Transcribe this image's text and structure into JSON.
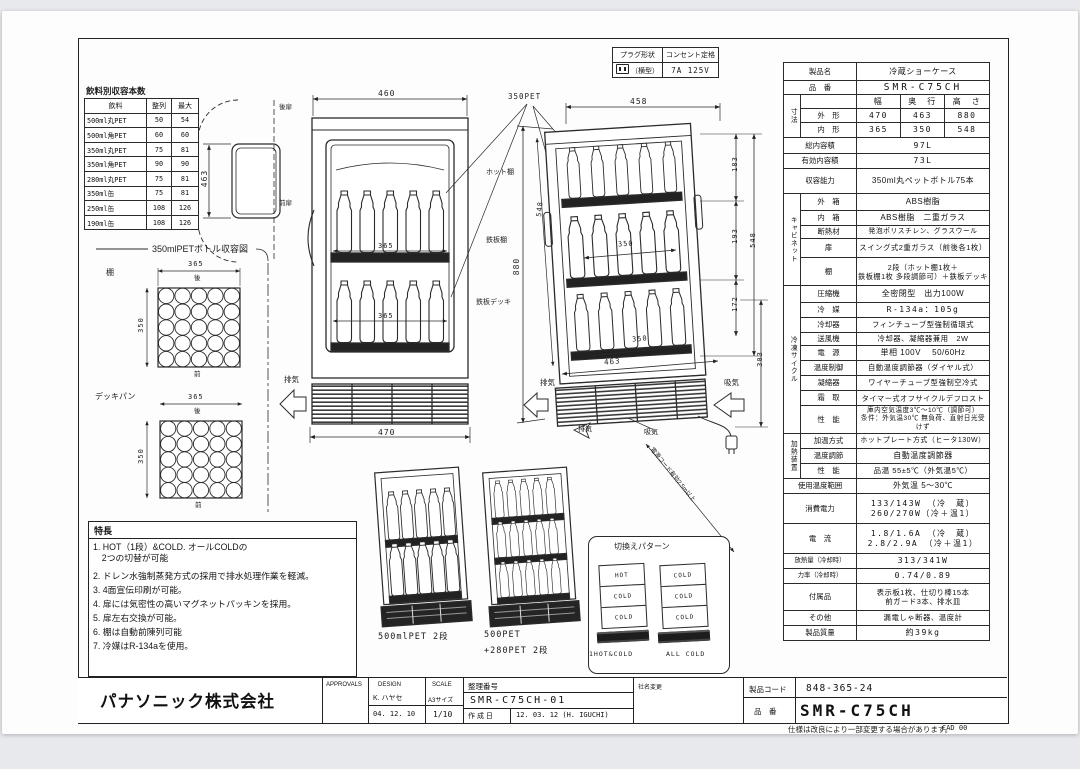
{
  "doc": {
    "sheet_note": "仕様は改良により一部変更する場合があります。",
    "cad_note": "CAD 00"
  },
  "plug_table": {
    "plug_header": "プラグ形状",
    "outlet_header": "コンセント定格",
    "plug_type": "（横型）",
    "outlet_rating": "7A 125V"
  },
  "capacity_table": {
    "title": "飲料別収容本数",
    "headers": [
      "飲料",
      "整列",
      "最大"
    ],
    "rows": [
      [
        "500ml丸PET",
        "50",
        "54"
      ],
      [
        "500ml角PET",
        "60",
        "60"
      ],
      [
        "350ml丸PET",
        "75",
        "81"
      ],
      [
        "350ml角PET",
        "90",
        "90"
      ],
      [
        "280ml丸PET",
        "75",
        "81"
      ],
      [
        "350ml缶",
        "75",
        "81"
      ],
      [
        "250ml缶",
        "108",
        "126"
      ],
      [
        "190ml缶",
        "108",
        "126"
      ]
    ]
  },
  "bottle_layout": {
    "title": "350mlPETボトル収容図",
    "shelf": "棚",
    "deck": "デッキパン",
    "width": "365",
    "depth": "350",
    "rear": "後",
    "front": "前"
  },
  "views": {
    "plan": {
      "depth": "463",
      "rear_door": "後扉",
      "front_door": "前扉"
    },
    "front": {
      "width_top": "460",
      "inner_width_1": "365",
      "inner_width_2": "365",
      "width_bottom": "470",
      "exhaust": "排気"
    },
    "side": {
      "pet": "350PET",
      "width_top": "458",
      "height": "880",
      "inner_height": "548",
      "seg1": "183",
      "seg2": "193",
      "seg3": "172",
      "inner_height_right": "548",
      "shelf_depth": "350",
      "deck_depth": "350",
      "depth_bottom": "463",
      "machine_height": "303",
      "hot_shelf": "ホット棚",
      "steel_shelf": "鉄板棚",
      "steel_deck": "鉄板デッキ",
      "exhaust_left": "排気",
      "intake_right": "吸気",
      "exhaust_bottom": "排気",
      "intake_bottom": "吸気",
      "cord_note": "電源コード有効2.5m以上"
    },
    "bottom_units": {
      "unit1": "500mlPET 2段",
      "unit2_line1": "500PET",
      "unit2_line2": "+280PET 2段"
    }
  },
  "switch_patterns": {
    "title": "切換えパターン",
    "unit1_bands": [
      "HOT",
      "COLD",
      "COLD"
    ],
    "unit1_label": "1HOT&COLD",
    "unit2_bands": [
      "COLD",
      "COLD",
      "COLD"
    ],
    "unit2_label": "ALL COLD"
  },
  "features": {
    "title": "特長",
    "items": [
      "1. HOT（1段）&COLD. オールCOLDの\n　2つの切替が可能",
      "2. ドレン水強制蒸発方式の採用で排水処理作業を軽減。",
      "3. 4面宣伝印刷が可能。",
      "4. 扉には気密性の高いマグネットパッキンを採用。",
      "5. 扉左右交換が可能。",
      "6. 棚は自動前陳列可能",
      "7. 冷媒はR-134aを使用。"
    ]
  },
  "spec_table": {
    "rows": [
      {
        "label": "製品名",
        "value": "冷蔵ショーケース",
        "h": 18,
        "full": true
      },
      {
        "label": "品　番",
        "value": "SMR-C75CH",
        "h": 14,
        "full": true,
        "big": true
      },
      {
        "group": "寸法",
        "gspan": 3,
        "label": "",
        "cols": [
          "幅",
          "奥　行",
          "高　さ"
        ],
        "h": 14
      },
      {
        "label": "外　形",
        "cols": [
          "470",
          "463",
          "880"
        ],
        "h": 14
      },
      {
        "label": "内　形",
        "cols": [
          "365",
          "350",
          "548"
        ],
        "h": 15
      },
      {
        "label": "総内容積",
        "value": "97L",
        "h": 16,
        "full": true,
        "num": true
      },
      {
        "label": "有効内容積",
        "value": "73L",
        "h": 15,
        "full": true,
        "num": true
      },
      {
        "label": "収容能力",
        "value": "350ml丸ペットボトル75本",
        "h": 25,
        "full": true
      },
      {
        "group": "キャビネット",
        "gspan": 5,
        "label": "外　箱",
        "value": "ABS樹脂",
        "h": 17
      },
      {
        "label": "内　箱",
        "value": "ABS樹脂　二重ガラス",
        "h": 15
      },
      {
        "label": "断熱材",
        "value": "発泡ポリスチレン、グラスウール",
        "h": 13,
        "fs": 6.8
      },
      {
        "label": "扉",
        "value": "スイング式2重ガラス（前後各1枚）",
        "h": 19,
        "fs": 7.4
      },
      {
        "label": "棚",
        "value": "2段（ホット棚1枚＋\n鉄板棚1枚 多段調節可）＋鉄板デッキ",
        "h": 28,
        "fs": 7.2
      },
      {
        "group": "冷凍サイクル",
        "gspan": 9,
        "label": "圧縮機",
        "value": "全密閉型　出力100W",
        "h": 17
      },
      {
        "label": "冷　媒",
        "value": "R-134a：105g",
        "h": 15,
        "num": true
      },
      {
        "label": "冷却器",
        "value": "フィンチューブ型強制循環式",
        "h": 15,
        "fs": 7.4
      },
      {
        "label": "送風機",
        "value": "冷却器、凝縮器兼用　2W",
        "h": 13,
        "fs": 7.4
      },
      {
        "label": "電　源",
        "value": "単相 100V　 50/60Hz",
        "h": 15
      },
      {
        "label": "温度制御",
        "value": "自動温度調節器（ダイヤル式）",
        "h": 15,
        "fs": 7.4
      },
      {
        "label": "凝縮器",
        "value": "ワイヤーチューブ型強制空冷式",
        "h": 15,
        "fs": 7.4
      },
      {
        "label": "霜　取",
        "value": "タイマー式オフサイクルデフロスト",
        "h": 15,
        "fs": 7.2
      },
      {
        "label": "性　能",
        "value": "庫内空気温度3℃～10℃（調節可）\n条件：外気温30℃ 無負荷、直射日光受けず",
        "h": 28,
        "fs": 6.6
      },
      {
        "group": "加熱装置",
        "gspan": 3,
        "label": "加温方式",
        "value": "ホットプレート方式（ヒータ130W）",
        "h": 15,
        "fs": 7
      },
      {
        "label": "温度調節",
        "value": "自動温度調節器",
        "h": 15
      },
      {
        "label": "性　能",
        "value": "品温 55±5℃（外気温5℃）",
        "h": 15,
        "fs": 7.6
      },
      {
        "label": "使用温度範囲",
        "value": "外気温 5～30℃",
        "h": 15,
        "full": true
      },
      {
        "label": "消費電力",
        "value": "133/143W （冷　蔵）\n260/270W（冷＋温1）",
        "h": 30,
        "full": true,
        "num": true
      },
      {
        "label": "電　流",
        "value": "1.8/1.6A （冷　蔵）\n2.8/2.9A （冷＋温1）",
        "h": 30,
        "full": true,
        "num": true
      },
      {
        "label": "放熱量（冷却時）",
        "value": "313/341W",
        "h": 15,
        "full": true,
        "num": true,
        "lfs": 6.4
      },
      {
        "label": "力率（冷却時）",
        "value": "0.74/0.89",
        "h": 15,
        "full": true,
        "num": true,
        "lfs": 6.4
      },
      {
        "label": "付属品",
        "value": "表示板1枚、仕切り棒15本\n前ガード3本、排水皿",
        "h": 27,
        "full": true,
        "fs": 7.4
      },
      {
        "label": "その他",
        "value": "漏電しゃ断器、温度計",
        "h": 15,
        "full": true,
        "fs": 7.4
      },
      {
        "label": "製品質量",
        "value": "約39kg",
        "h": 15,
        "full": true,
        "num": true
      }
    ]
  },
  "title_block": {
    "company": "パナソニック株式会社",
    "approvals": "APPROVALS",
    "design": "DESIGN",
    "scale": "SCALE",
    "designer": "K. ハヤセ",
    "design_date": "04. 12. 10",
    "paper_size": "A3サイズ",
    "scale_value": "1/10",
    "doc_no_label": "整理番号",
    "doc_no": "SMR-C75CH-01",
    "created_label": "作 成 日",
    "created": "12. 03. 12 (H. IGUCHI)",
    "revision": "社名変更",
    "product_code_label": "製品コード",
    "product_code": "848-365-24",
    "model_label": "品　番",
    "model": "SMR-C75CH"
  }
}
